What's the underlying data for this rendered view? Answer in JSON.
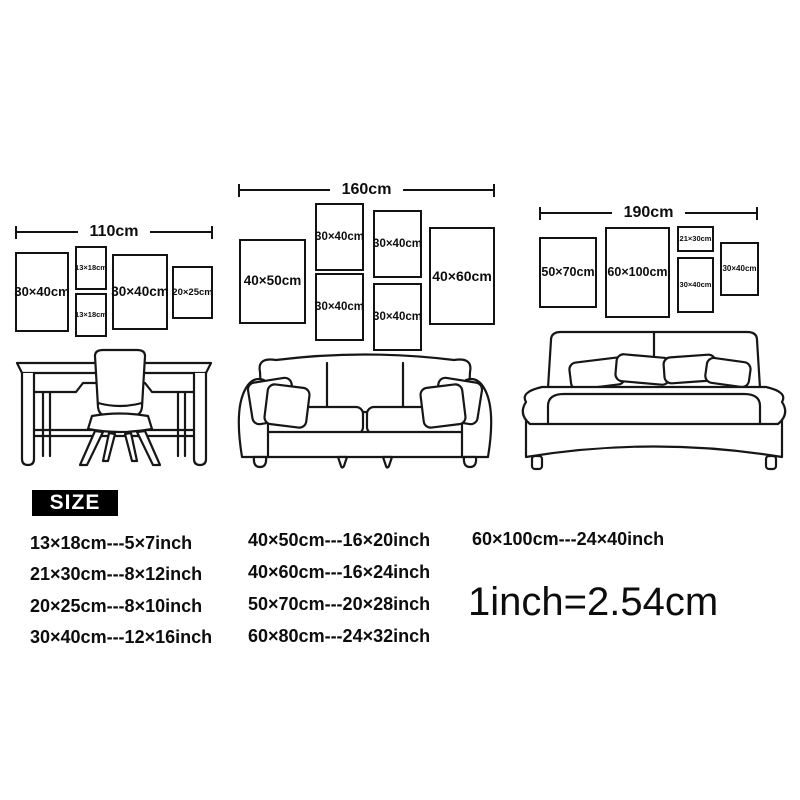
{
  "page": {
    "background_color": "#ffffff",
    "ink_color": "#121212"
  },
  "wall_groups": [
    {
      "width_label": "110cm",
      "frames": [
        {
          "label": "30×40cm"
        },
        {
          "label": "13×18cm"
        },
        {
          "label": "13×18cm"
        },
        {
          "label": "30×40cm"
        },
        {
          "label": "20×25cm"
        }
      ]
    },
    {
      "width_label": "160cm",
      "frames": [
        {
          "label": "40×50cm"
        },
        {
          "label": "30×40cm"
        },
        {
          "label": "30×40cm"
        },
        {
          "label": "30×40cm"
        },
        {
          "label": "30×40cm"
        },
        {
          "label": "40×60cm"
        }
      ]
    },
    {
      "width_label": "190cm",
      "frames": [
        {
          "label": "50×70cm"
        },
        {
          "label": "60×100cm"
        },
        {
          "label": "21×30cm"
        },
        {
          "label": "30×40cm"
        },
        {
          "label": "30×40cm"
        }
      ]
    }
  ],
  "furniture_icons": [
    "desk-with-chair",
    "sofa",
    "bed"
  ],
  "size_legend": {
    "title": "SIZE",
    "columns": [
      [
        "13×18cm---5×7inch",
        "21×30cm---8×12inch",
        "20×25cm---8×10inch",
        "30×40cm---12×16inch"
      ],
      [
        "40×50cm---16×20inch",
        "40×60cm---16×24inch",
        "50×70cm---20×28inch",
        "60×80cm---24×32inch"
      ],
      [
        "60×100cm---24×40inch"
      ]
    ],
    "conversion": "1inch=2.54cm"
  }
}
